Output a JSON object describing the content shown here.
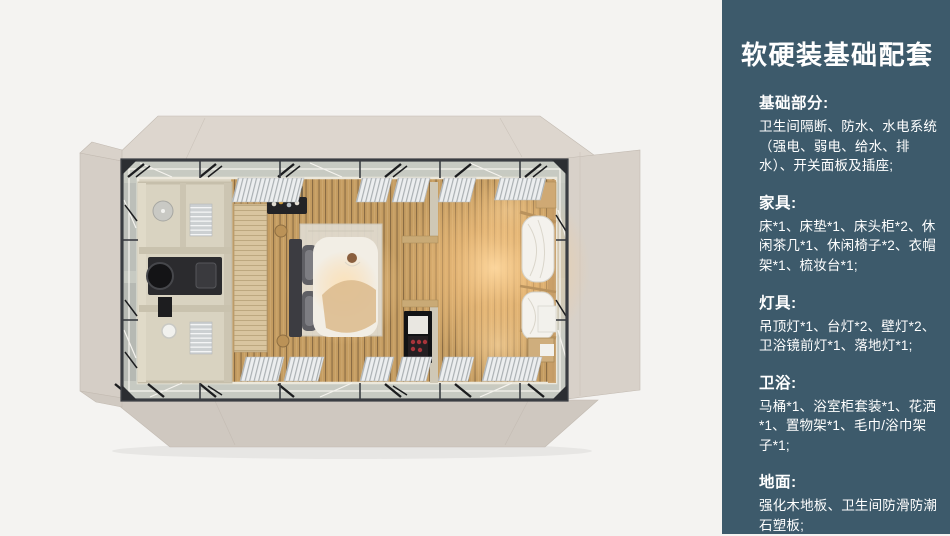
{
  "panel": {
    "title": "软硬装基础配套",
    "background": "#3d5a6b",
    "text_color": "#ffffff",
    "sections": [
      {
        "heading": "基础部分:",
        "body": "卫生间隔断、防水、水电系统（强电、弱电、给水、排水）、开关面板及插座;"
      },
      {
        "heading": "家具:",
        "body": "床*1、床垫*1、床头柜*2、休闲茶几*1、休闲椅子*2、衣帽架*1、梳妆台*1;"
      },
      {
        "heading": "灯具:",
        "body": "吊顶灯*1、台灯*2、壁灯*2、卫浴镜前灯*1、落地灯*1;"
      },
      {
        "heading": "卫浴:",
        "body": "马桶*1、浴室柜套装*1、花洒*1、置物架*1、毛巾/浴巾架子*1;"
      },
      {
        "heading": "地面:",
        "body": "强化木地板、卫生间防滑防潮石塑板;"
      }
    ]
  },
  "floorplan": {
    "description": "top-down 3D render of a prefab cabin suite: bathroom at left, double bed in centre, shelving partition and bunk beds with curtains at right, glass walls with steel frame and folded-out beige wall panels",
    "features": [
      "steel-frame",
      "glass-wall-deck",
      "folded-wall-panels",
      "bathroom",
      "shower-head",
      "vanity-with-round-mirror",
      "toilet-paper-holder",
      "towel-racks",
      "wardrobe",
      "double-bed",
      "headboard",
      "pillows",
      "rug",
      "hanging-bottle-rack",
      "side-stools",
      "partition-shelves",
      "bar-cabinet",
      "bunk-beds",
      "white-curtains",
      "window-blinds",
      "wood-slat-floor",
      "warm-lamp-glow"
    ],
    "colors": {
      "background": "#f4f3f1",
      "flap_beige": "#ddd6ce",
      "deck_gray": "#c7cac2",
      "wood_floor": "#c49c61",
      "bathroom_beige": "#d9d3c1",
      "steel_frame": "#3a3d42",
      "bed_duvet": "#f2eee5",
      "headboard": "#3c3c41",
      "glow_warm": "#ffca85"
    }
  }
}
